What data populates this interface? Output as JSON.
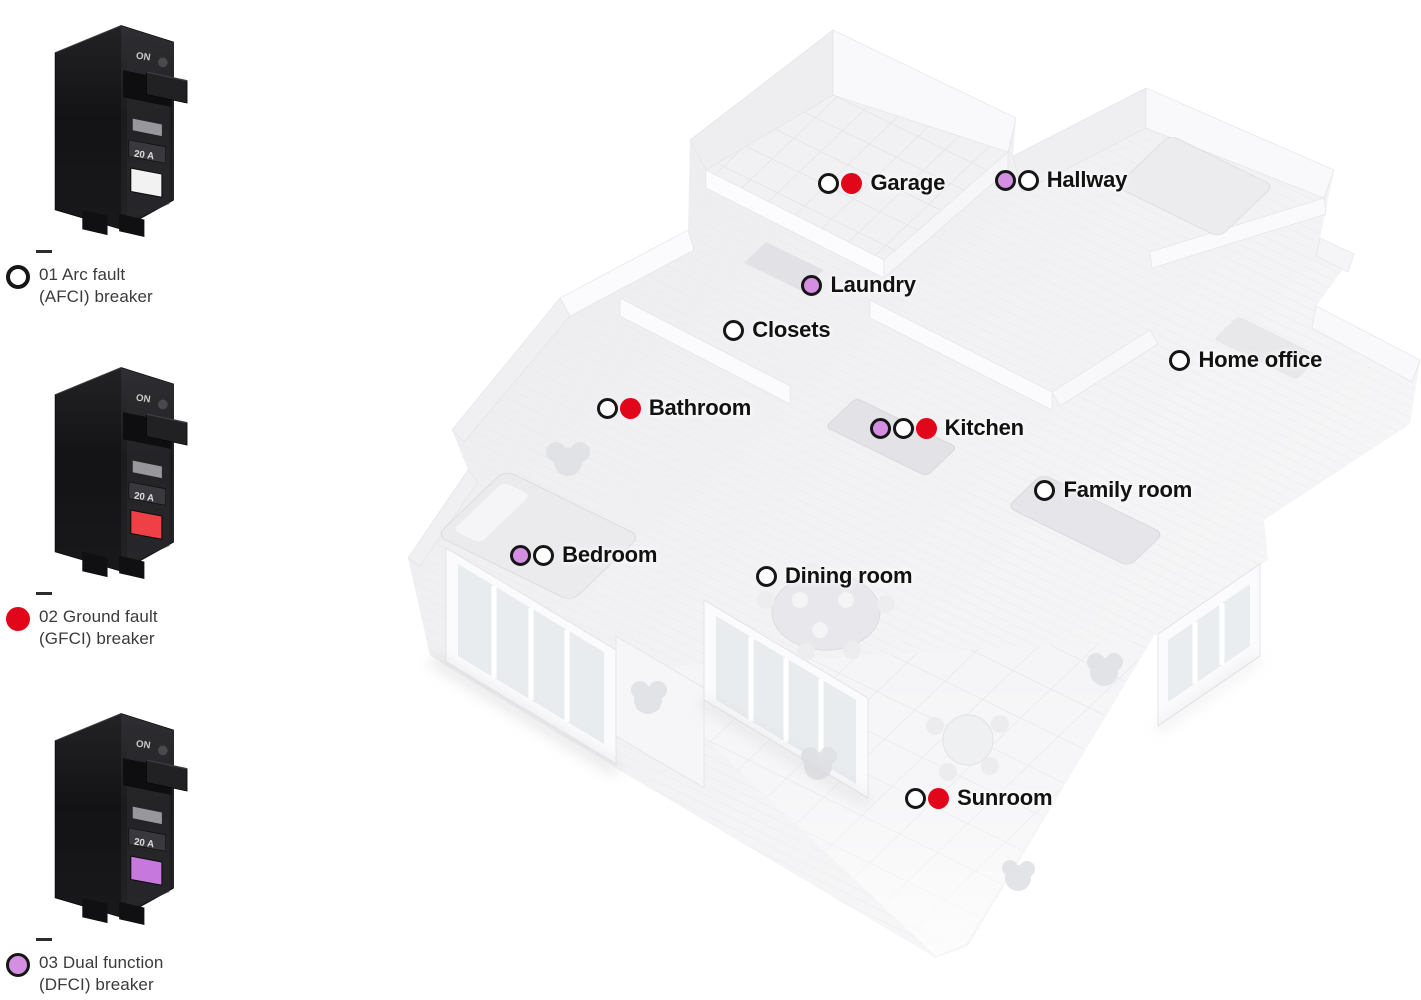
{
  "colors": {
    "red": "#e2061a",
    "purple": "#d48fe3",
    "dot_outline": "#161616",
    "plan_label_text": "#121212",
    "legend_text": "#3b3b3b"
  },
  "legend": {
    "breaker_on_text": "ON",
    "breaker_amp_text": "20 A",
    "items": [
      {
        "id": "afci",
        "line1": "01 Arc fault",
        "line2": "(AFCI) breaker",
        "dot": "afci",
        "button_color": "#f2f2f2"
      },
      {
        "id": "gfci",
        "line1": "02 Ground fault",
        "line2": "(GFCI) breaker",
        "dot": "gfci",
        "button_color": "#ef4048"
      },
      {
        "id": "dfci",
        "line1": "03 Dual function",
        "line2": "(DFCI) breaker",
        "dot": "dfci",
        "button_color": "#c678dd"
      }
    ]
  },
  "floorplan": {
    "rooms": [
      {
        "name": "Garage",
        "dots": [
          "afci",
          "gfci"
        ],
        "x": 57.6,
        "y": 18.3
      },
      {
        "name": "Hallway",
        "dots": [
          "dfci",
          "afci"
        ],
        "x": 70.0,
        "y": 18.0
      },
      {
        "name": "Laundry",
        "dots": [
          "dfci"
        ],
        "x": 56.4,
        "y": 28.5
      },
      {
        "name": "Closets",
        "dots": [
          "afci"
        ],
        "x": 50.9,
        "y": 33.0
      },
      {
        "name": "Home office",
        "dots": [
          "afci"
        ],
        "x": 82.3,
        "y": 36.0
      },
      {
        "name": "Bathroom",
        "dots": [
          "afci",
          "gfci"
        ],
        "x": 42.0,
        "y": 40.8
      },
      {
        "name": "Kitchen",
        "dots": [
          "dfci",
          "afci",
          "gfci"
        ],
        "x": 61.2,
        "y": 42.8
      },
      {
        "name": "Family room",
        "dots": [
          "afci"
        ],
        "x": 72.8,
        "y": 49.0
      },
      {
        "name": "Bedroom",
        "dots": [
          "dfci",
          "afci"
        ],
        "x": 35.9,
        "y": 55.5
      },
      {
        "name": "Dining room",
        "dots": [
          "afci"
        ],
        "x": 53.2,
        "y": 57.6
      },
      {
        "name": "Sunroom",
        "dots": [
          "afci",
          "gfci"
        ],
        "x": 63.7,
        "y": 79.8
      }
    ]
  }
}
